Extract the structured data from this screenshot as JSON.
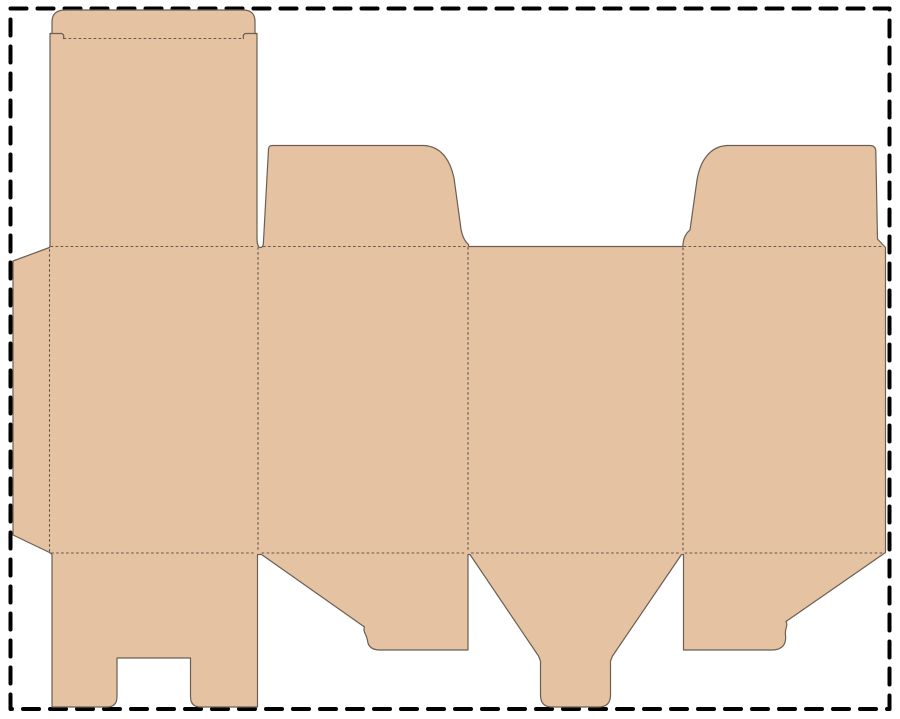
{
  "document": {
    "kind": "packaging dieline template (unfolded tuck-end carton blank)",
    "has_text": false
  },
  "canvas": {
    "width": 900,
    "height": 719,
    "background_color": "#ffffff"
  },
  "page_border": {
    "color": "#000000",
    "thickness": "4",
    "dash_pattern": "16 11",
    "x": "10.5",
    "y": "8.5",
    "w": "879",
    "h": "700.5"
  },
  "dieline": {
    "board_fill_color": "#e5c2a1",
    "cut_line_color": "#6b5f53",
    "cut_line_width": "1.2",
    "fold_line_color": "#63564a",
    "fold_line_width": "1.1",
    "fold_dash_pattern": "1.8 3.2",
    "parts": [
      {
        "name": "glue-flap",
        "side": "left"
      },
      {
        "name": "front-panel",
        "position": "panel-1"
      },
      {
        "name": "lid-panel-with-tuck-tab",
        "position": "above-panel-1"
      },
      {
        "name": "side-panel",
        "position": "panel-2"
      },
      {
        "name": "top-dust-flap",
        "position": "above-panel-2"
      },
      {
        "name": "back-panel",
        "position": "panel-3"
      },
      {
        "name": "side-panel",
        "position": "panel-4"
      },
      {
        "name": "top-dust-flap",
        "position": "above-panel-4"
      },
      {
        "name": "bottom-flap-with-lock-notch",
        "position": "below-panel-1"
      },
      {
        "name": "bottom-dust-flap",
        "position": "below-panel-2"
      },
      {
        "name": "bottom-tongue-flap",
        "position": "below-panel-3"
      },
      {
        "name": "bottom-dust-flap",
        "position": "below-panel-4"
      }
    ],
    "paths": {
      "blank_outline": "M 13 261 L 49.5 247.5 L 50 246 L 50 33.5 L 52 33.5 L 52 22 C 52 13.5 57 10 65.5 10 L 242.5 10 C 251 10 255 13.5 255 22 L 255 33.5 L 257 33.5 L 257 238 C 257 244.5 258.5 247.5 260.5 247.5 C 262.5 247.5 263.5 245 263.5 241 L 268.5 149 C 268.7 146.5 269.8 145.5 272.5 145.5 L 424 145.5 C 441 146.5 450 160 454 178 L 461 229 Q 463 240 468.5 244.5 L 468.5 246.5 L 683 246.5 L 683 244 Q 684 234.5 690 230 L 697 180 C 700 162 709 146.5 727 145.5 L 870 145.5 Q 875.5 145.5 875.8 151 L 877.5 239 L 885.5 247.5 L 885.5 552.5 L 786 621.5 C 788.5 625.5 784.5 628.5 785.5 635 C 786.5 644 782.5 650 772 650 L 683.5 650 L 683.5 554.5 L 681.5 554.5 L 612.5 656 L 610.5 661 L 610.5 695 Q 610.5 707 598.5 707 L 552 707 Q 540.5 707 540.5 695 L 540.5 661 L 538.5 656 L 470 554.5 L 468 554.5 L 468 650 L 380 650 Q 368.5 650 367.5 640.5 C 366.5 634 362.5 631.5 364.5 627 L 261.5 554.5 L 257.5 554.5 L 257.5 707 L 200.5 707 Q 190.5 707 190.5 696.5 L 190.5 658 L 117 658 L 117 696.5 Q 117 707 107 707 L 52 707 L 52 554.5 L 49.5 552.5 L 13 535 Z",
      "tuck_lock_slits": "M 50 33.5 L 61.5 33.5 Q 64.5 34.5 63.5 38.5 M 257 33.5 L 245.5 33.5 Q 242.5 34.5 243.5 38.5",
      "fold_lines": "M 64 38.5 H 243 M 51 246.5 H 255 M 263.5 246.5 H 467.5 M 684 246.5 H 884 M 51.5 553 H 256.5 M 262 553 H 467 M 471.5 553 H 680 M 685 553 H 884 M 49.5 249.5 V 551.5 M 258 247.5 V 552 M 468 247.5 V 552 M 683 248 V 552"
    }
  }
}
